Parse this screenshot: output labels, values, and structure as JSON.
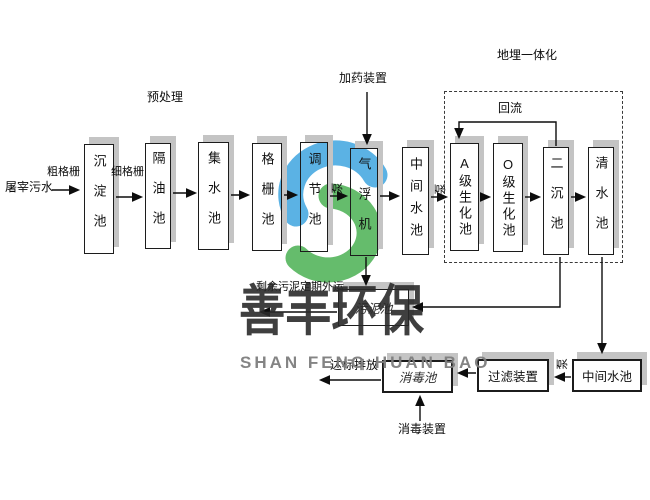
{
  "watermark": {
    "company_cn": "善丰环保",
    "company_en": "SHAN FENG HUAN BAO",
    "logo_blue": "#3FA5E0",
    "logo_green": "#4BB153"
  },
  "flow": {
    "source": "屠宰污水",
    "stage_pretreatment": "预处理",
    "coarse_screen": "粗格栅",
    "fine_screen": "细格栅",
    "dosing_device": "加药装置",
    "buried_integrated": "地埋一体化",
    "reflux": "回流",
    "pump": "泵",
    "excess_sludge_out": "剩余污泥定期外运",
    "discharge": "达标排放",
    "disinfection_device": "消毒装置",
    "tanks": {
      "sedimentation": "沉淀池",
      "oil_separation": "隔油池",
      "water_collection": "集水池",
      "grid": "格栅池",
      "regulation": "调节池",
      "air_flotation": "气浮机",
      "intermediate_1": "中间水池",
      "a_bio": "A级生化池",
      "o_bio": "O级生化池",
      "secondary_sedimentation": "二沉池",
      "clear_water": "清水池",
      "sludge": "污泥池",
      "disinfection": "消毒池",
      "filtration": "过滤装置",
      "intermediate_2": "中间水池"
    }
  }
}
